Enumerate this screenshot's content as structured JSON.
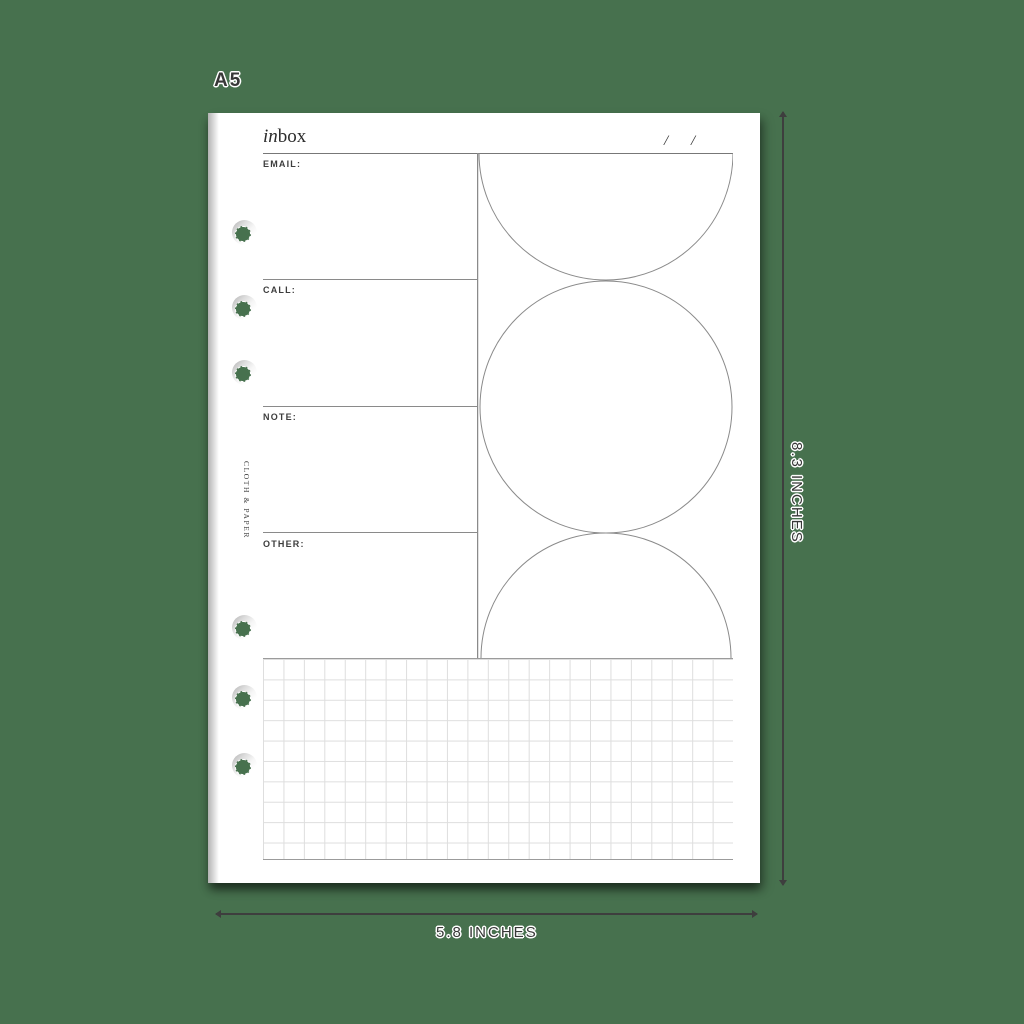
{
  "mockup": {
    "size_label": "A5",
    "background_color": "#47714E",
    "line_color": "#8a8a8a",
    "label_color": "#383838"
  },
  "page": {
    "title": {
      "italic_part": "in",
      "regular_part": "box"
    },
    "date_slashes": [
      "/",
      "/"
    ],
    "sections": [
      {
        "label": "EMAIL:"
      },
      {
        "label": "CALL:"
      },
      {
        "label": "NOTE:"
      },
      {
        "label": "OTHER:"
      }
    ],
    "brand_vertical_text": "CLOTH & PAPER",
    "holes_count": 6
  },
  "dimensions": {
    "height_label": "8.3 INCHES",
    "width_label": "5.8 INCHES"
  }
}
